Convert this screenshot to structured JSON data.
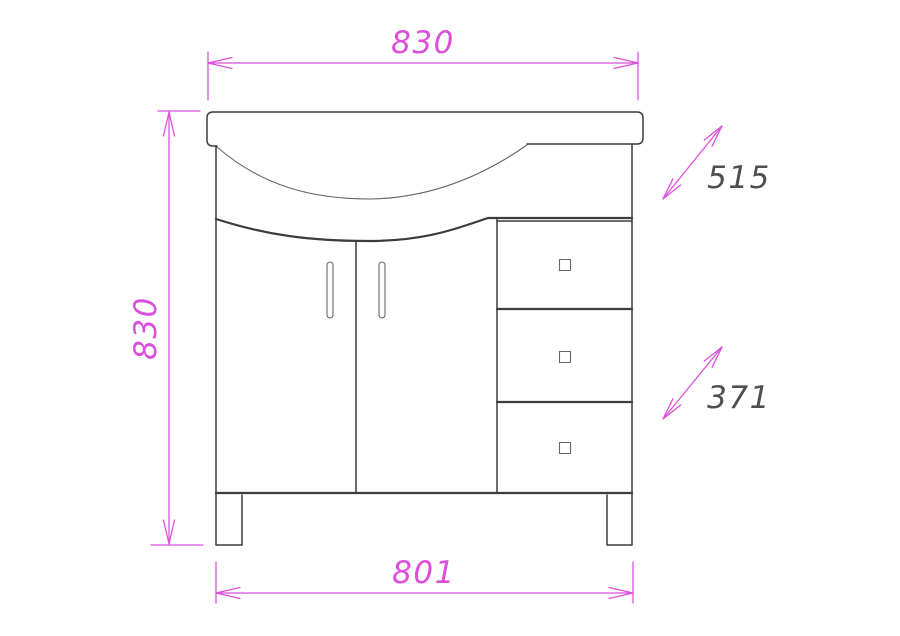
{
  "drawing": {
    "labels": {
      "top_width": "830",
      "left_height": "830",
      "upper_diagonal_depth": "515",
      "lower_diagonal_depth": "371",
      "bottom_width": "801"
    },
    "colors": {
      "dimension": "#dc4edc",
      "outline": "#3c3c3c",
      "diagonal_text": "#4f4f4f",
      "background": "#ffffff"
    }
  }
}
